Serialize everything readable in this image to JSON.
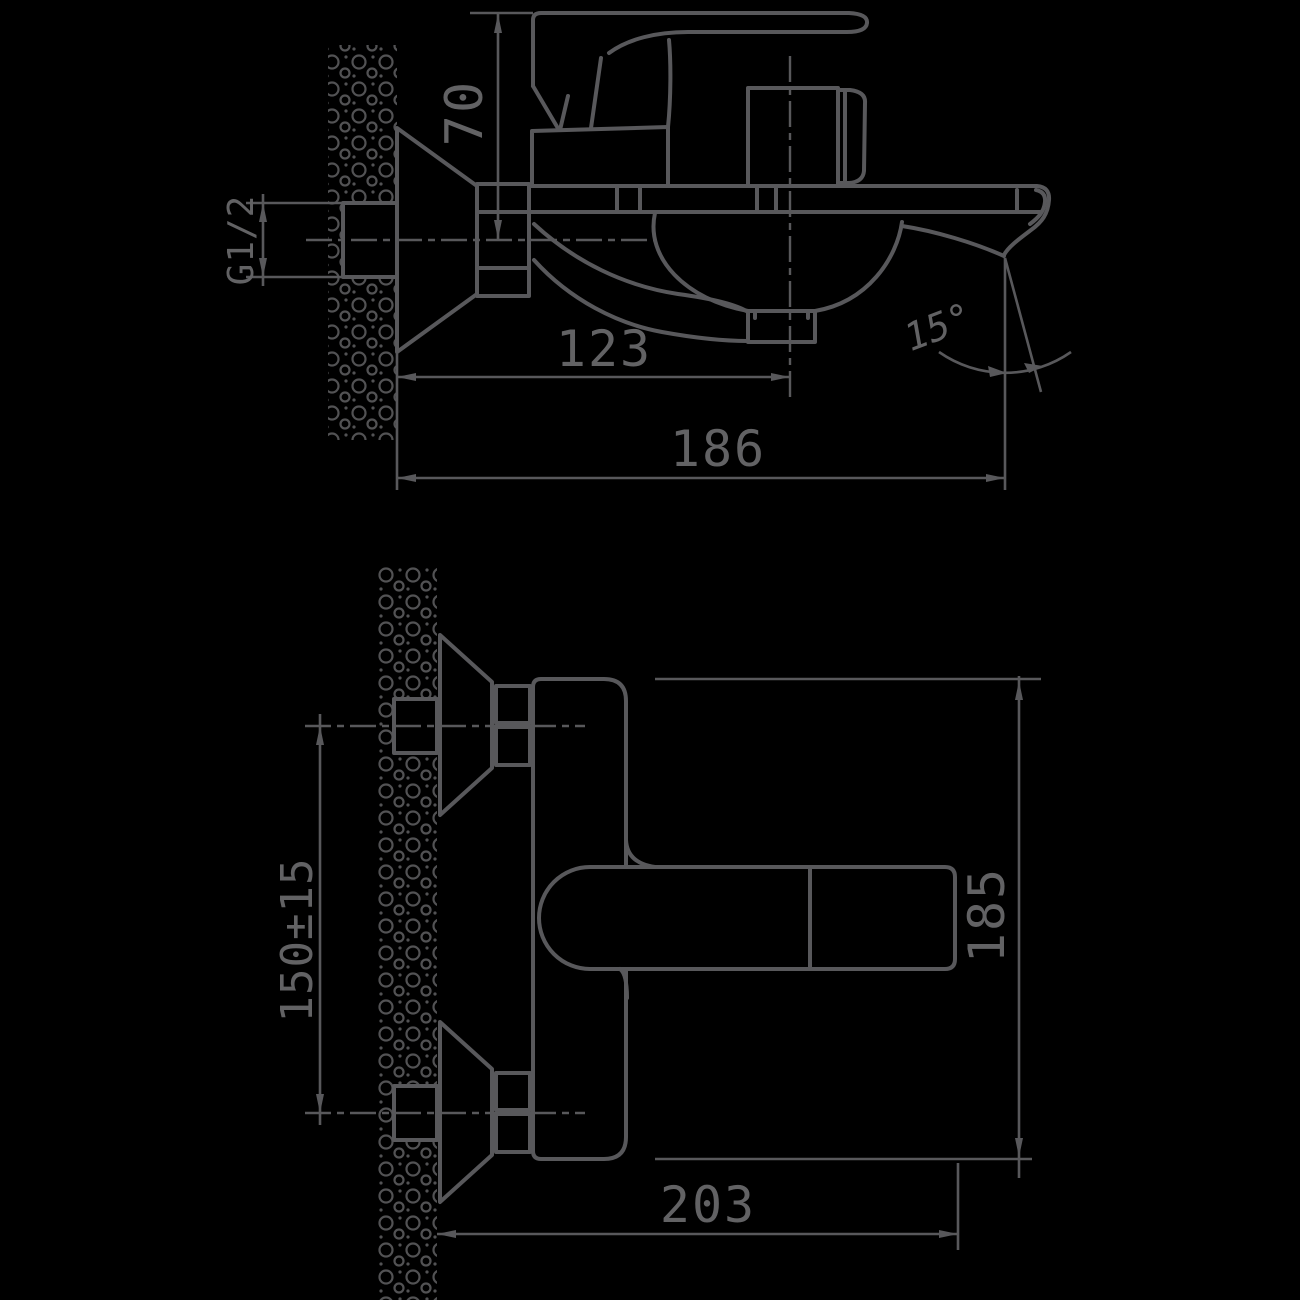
{
  "drawing": {
    "type": "technical-dimension-drawing",
    "subject": "wall-mounted bath mixer faucet, two orthographic views",
    "background_color": "#000000",
    "line_color": "#58585b",
    "side_view": {
      "dimensions": {
        "handle_height": "70",
        "inlet_thread": "G1/2",
        "spout_center_reach": "123",
        "total_reach": "186",
        "spout_tip_angle": "15°"
      }
    },
    "plan_view": {
      "dimensions": {
        "inlet_spacing": "150±15",
        "body_height": "185",
        "body_length": "203"
      }
    }
  }
}
